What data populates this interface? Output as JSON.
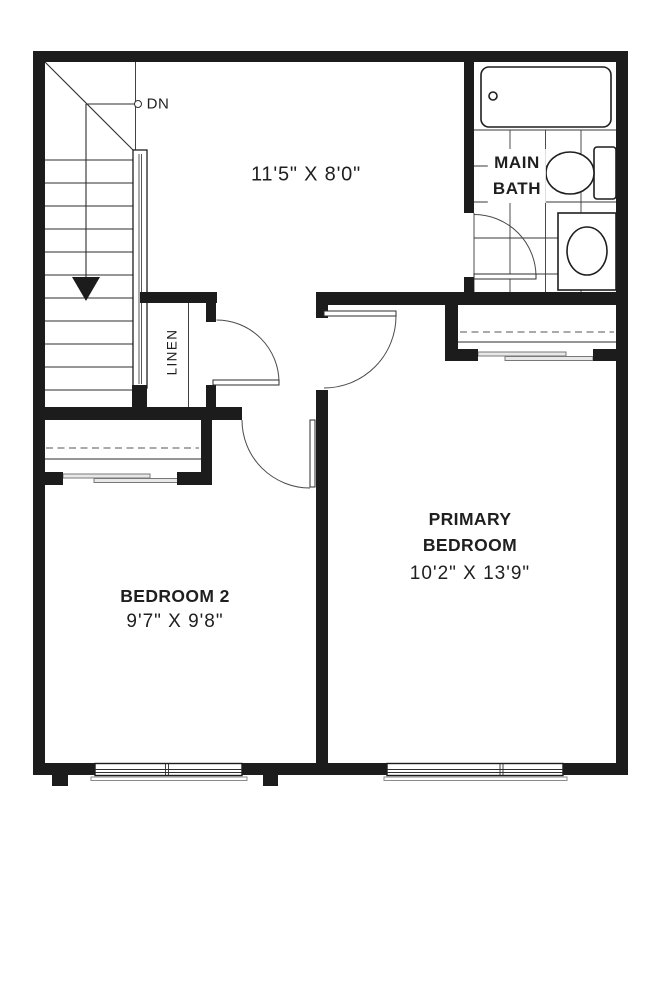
{
  "plan": {
    "stairs": {
      "dn_label": "DN"
    },
    "hall": {
      "dims": "11'5\" X 8'0\""
    },
    "main_bath": {
      "line1": "MAIN",
      "line2": "BATH"
    },
    "linen": {
      "label": "LINEN"
    },
    "bedroom2": {
      "name": "BEDROOM 2",
      "dims": "9'7\" X 9'8\""
    },
    "primary_bedroom": {
      "line1": "PRIMARY",
      "line2": "BEDROOM",
      "dims": "10'2\" X 13'9\""
    },
    "colors": {
      "wall": "#1c1c1c",
      "line": "#2e2e2e",
      "soft_gray": "#8a8a8a",
      "background": "#ffffff"
    }
  }
}
